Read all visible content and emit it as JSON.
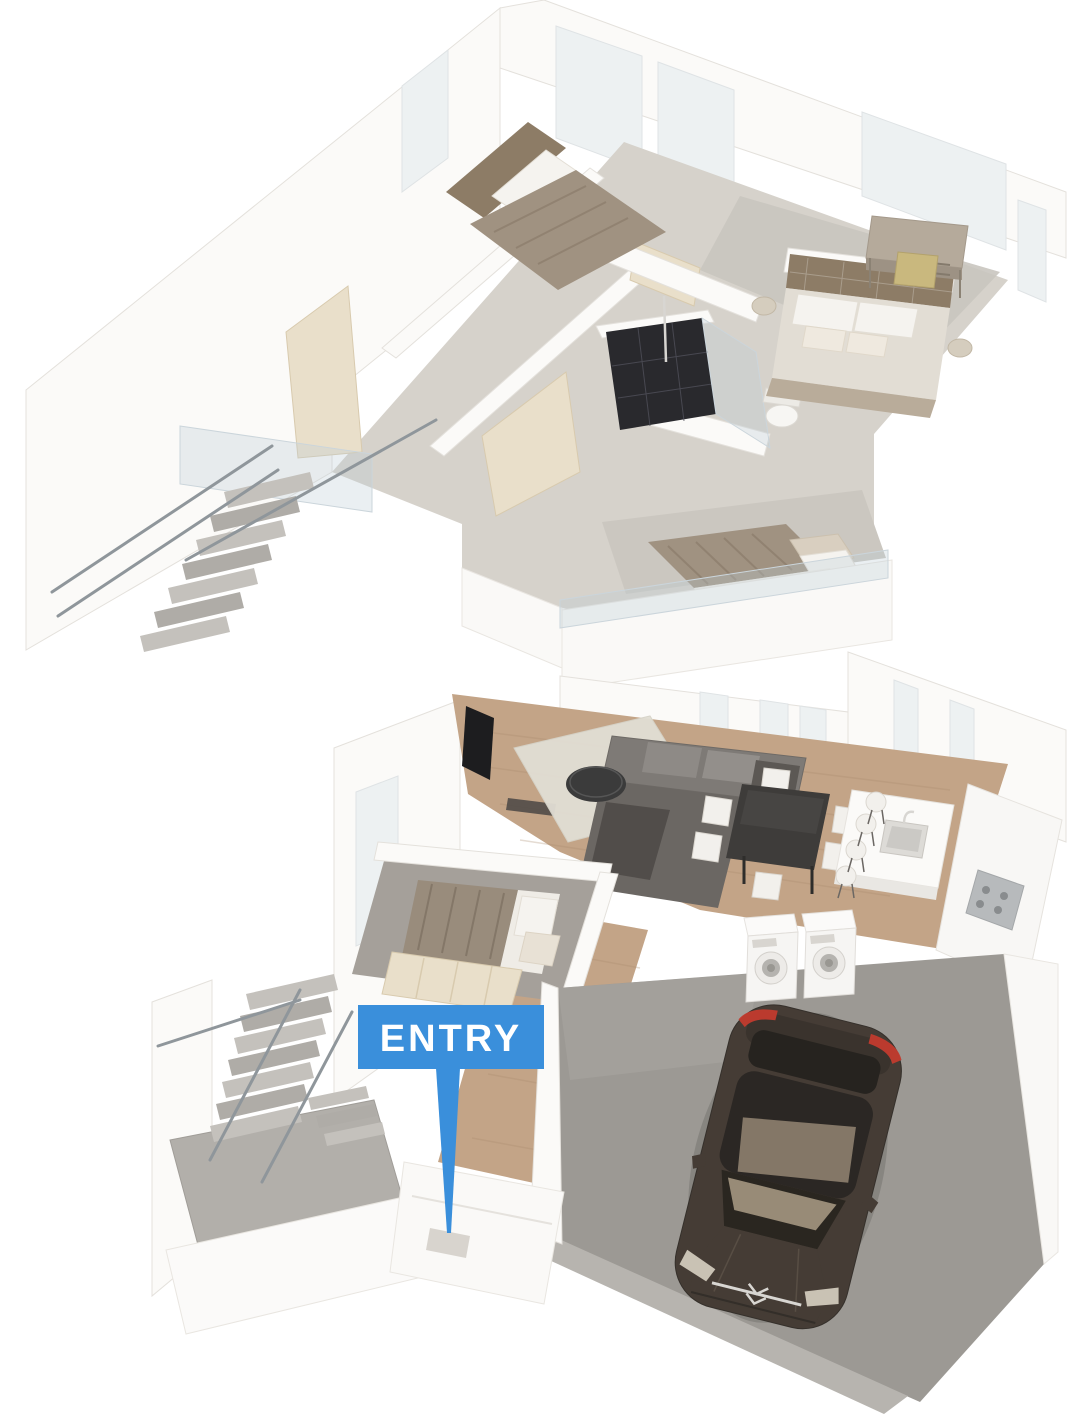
{
  "marker": {
    "label": "ENTRY",
    "background": "#3A8FDB",
    "text_color": "#FFFFFF"
  },
  "palette": {
    "wall": "#FBFAF8",
    "wall_edge": "#E4E1DC",
    "cream": "#E9DFCA",
    "cream_dark": "#D8CAAE",
    "carpet_upper": "#D6D2CB",
    "carpet_bedroom": "#A5A09A",
    "wood": "#C3A487",
    "wood_dark": "#A98A6D",
    "concrete": "#9C9994",
    "concrete_light": "#B7B4AF",
    "glass": "#BECDD7",
    "steel": "#8F969B",
    "shower_dark": "#29292D",
    "tv_dark": "#1D1D1F",
    "sofa": "#7E7A76",
    "sofa_dark": "#6B6763",
    "table_dark": "#3E3C3A",
    "chair_white": "#F2F0EC",
    "bed_taupe": "#A09281",
    "headboard": "#8D7C66",
    "pillow": "#F5F3EF",
    "car_body": "#453C35",
    "car_glass": "#26231F",
    "car_reflection": "#A3937D",
    "car_red": "#C23B2E",
    "chrome": "#D8D6D2",
    "appliance": "#F6F5F3"
  },
  "scene": {
    "type": "two-story-3d-floorplan",
    "floors": [
      {
        "name": "upper-floor",
        "objects": [
          "staircase",
          "glass-balustrade",
          "double-bed",
          "tufted-headboard-bed",
          "single-bed",
          "walk-in-closet",
          "shower",
          "toilet",
          "desk",
          "desk-chair",
          "windows"
        ]
      },
      {
        "name": "lower-floor",
        "objects": [
          "staircase",
          "entry-marker",
          "double-bed",
          "wardrobe",
          "sofa",
          "coffee-table",
          "tv",
          "rug",
          "dining-table",
          "dining-chairs",
          "kitchen-island",
          "bar-stools",
          "sink",
          "cooktop",
          "washer",
          "dryer",
          "garage",
          "car"
        ]
      }
    ]
  }
}
